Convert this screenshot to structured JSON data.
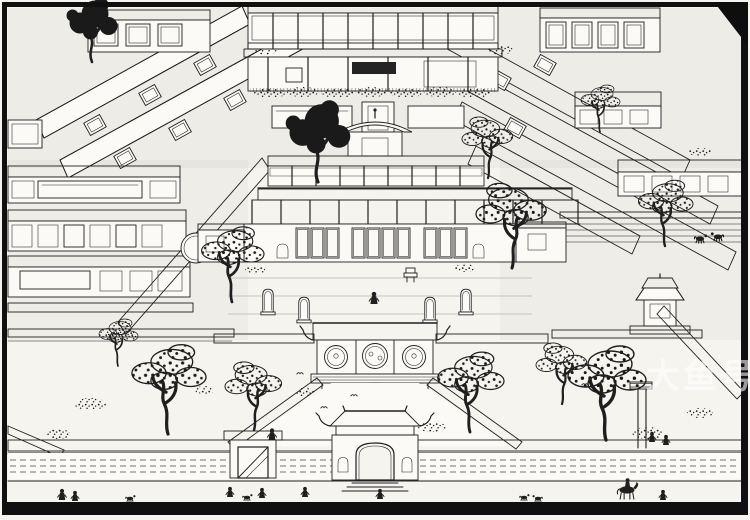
{
  "artwork": {
    "alt": "Woodblock-style engraving: bird's-eye view of a grand Chinese courtyard mansion with rows of tiled halls, covered galleries, gnarled trees, stone tablets, a gate pavilion with round windows, an outer wall with arched main gate, and tiny travellers and horsemen on the road outside",
    "watermark_text": "大鱼号"
  },
  "palette": {
    "paper": "#f6f4ef",
    "ink": "#1f1f1f",
    "frame": "#101010",
    "watermark_fill": "#ffffff"
  }
}
